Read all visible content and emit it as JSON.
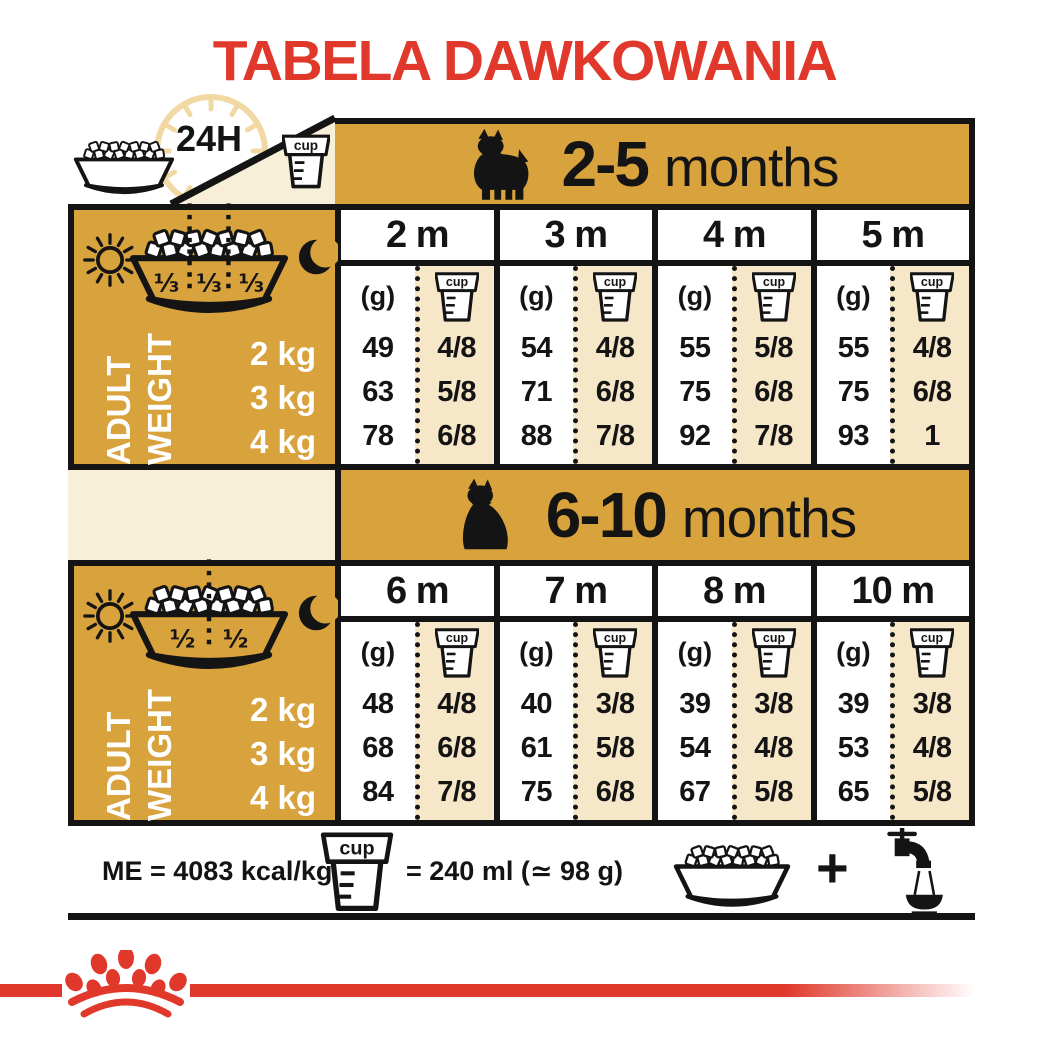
{
  "title": "TABELA DAWKOWANIA",
  "labels": {
    "h24": "24H",
    "cup": "cup",
    "adult": "ADULT",
    "weight": "WEIGHT",
    "unit_g": "(g)",
    "plus": "+"
  },
  "weights": [
    "2 kg",
    "3 kg",
    "4 kg"
  ],
  "tables": [
    {
      "age_bold": "2-5",
      "age_rest": "months",
      "fractions": [
        "⅓",
        "⅓",
        "⅓"
      ],
      "months": [
        {
          "label": "2 m",
          "grams": [
            "49",
            "63",
            "78"
          ],
          "cups": [
            "4/8",
            "5/8",
            "6/8"
          ]
        },
        {
          "label": "3 m",
          "grams": [
            "54",
            "71",
            "88"
          ],
          "cups": [
            "4/8",
            "6/8",
            "7/8"
          ]
        },
        {
          "label": "4 m",
          "grams": [
            "55",
            "75",
            "92"
          ],
          "cups": [
            "5/8",
            "6/8",
            "7/8"
          ]
        },
        {
          "label": "5 m",
          "grams": [
            "55",
            "75",
            "93"
          ],
          "cups": [
            "4/8",
            "6/8",
            "1"
          ]
        }
      ]
    },
    {
      "age_bold": "6-10",
      "age_rest": "months",
      "fractions": [
        "½",
        "½"
      ],
      "months": [
        {
          "label": "6 m",
          "grams": [
            "48",
            "68",
            "84"
          ],
          "cups": [
            "4/8",
            "6/8",
            "7/8"
          ]
        },
        {
          "label": "7 m",
          "grams": [
            "40",
            "61",
            "75"
          ],
          "cups": [
            "3/8",
            "5/8",
            "6/8"
          ]
        },
        {
          "label": "8 m",
          "grams": [
            "39",
            "54",
            "67"
          ],
          "cups": [
            "3/8",
            "4/8",
            "5/8"
          ]
        },
        {
          "label": "10 m",
          "grams": [
            "39",
            "53",
            "65"
          ],
          "cups": [
            "3/8",
            "4/8",
            "5/8"
          ]
        }
      ]
    }
  ],
  "footer": {
    "me": "ME = 4083 kcal/kg",
    "cup_equals": "= 240 ml (≃ 98 g)"
  },
  "icons": [
    "24h-clock",
    "food-bowl",
    "measuring-cup",
    "sun",
    "moon",
    "puppy-silhouette",
    "junior-dog-silhouette",
    "water-tap",
    "plus",
    "royal-canin-crown"
  ],
  "colors": {
    "red": "#E0392B",
    "gold": "#D8A23C",
    "cream": "#F8EFD8",
    "beige": "#F5E7C7",
    "tan": "#F2D9A4",
    "ink": "#141414"
  }
}
